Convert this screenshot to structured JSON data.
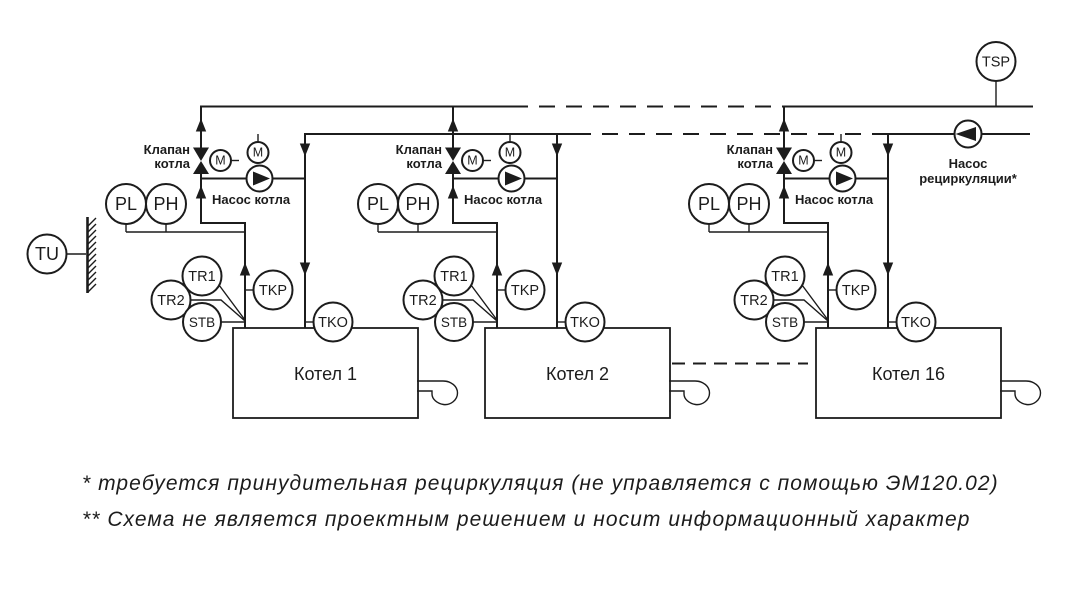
{
  "diagram": {
    "units": [
      {
        "boiler_label": "Котел 1"
      },
      {
        "boiler_label": "Котел 2"
      },
      {
        "boiler_label": "Котел 16"
      }
    ],
    "sensor_labels": {
      "tu": "TU",
      "tsp": "TSP",
      "pl": "PL",
      "ph": "PH",
      "tr1": "TR1",
      "tr2": "TR2",
      "stb": "STB",
      "tkp": "TKP",
      "tko": "TKO",
      "motor": "M"
    },
    "equipment_labels": {
      "boiler_valve_line1": "Клапан",
      "boiler_valve_line2": "котла",
      "boiler_pump": "Насос котла",
      "recirculation_pump_line1": "Насос",
      "recirculation_pump_line2": "рециркуляции*"
    },
    "footnotes": {
      "line1": "* требуется принудительная рециркуляция (не управляется с помощью ЭМ120.02)",
      "line2": "** Схема не является проектным решением и носит информационный характер"
    },
    "colors": {
      "line": "#1c1c1c",
      "background": "#ffffff"
    }
  }
}
